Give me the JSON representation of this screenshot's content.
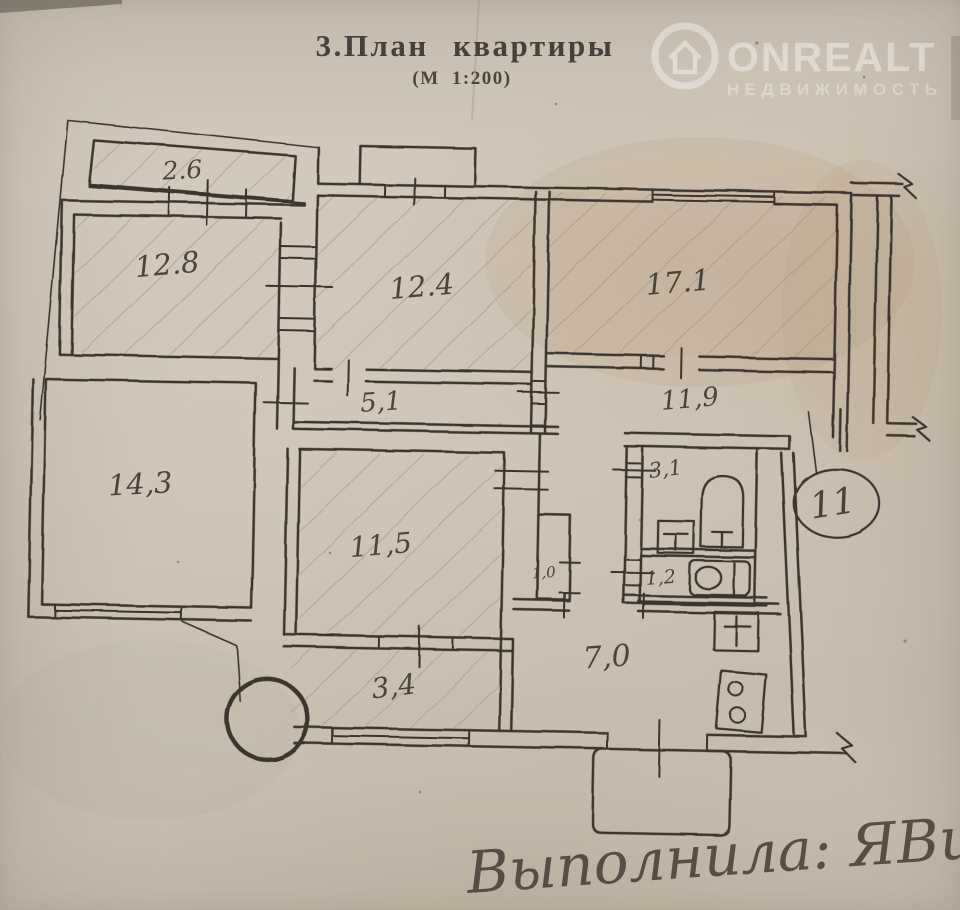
{
  "page": {
    "title": "3.План квартиры",
    "scale_note": "(М 1:200)"
  },
  "watermark": {
    "brand": "ONREALT",
    "subtitle": "НЕДВИЖИМОСТЬ"
  },
  "plan": {
    "unit_number": "11",
    "rooms": [
      {
        "name": "balcony",
        "area": "2.6"
      },
      {
        "name": "room",
        "area": "12.8"
      },
      {
        "name": "room",
        "area": "12.4"
      },
      {
        "name": "room",
        "area": "17.1"
      },
      {
        "name": "corridor",
        "area": "5,1"
      },
      {
        "name": "corridor",
        "area": "11,9"
      },
      {
        "name": "room",
        "area": "14,3"
      },
      {
        "name": "room",
        "area": "11,5"
      },
      {
        "name": "closet",
        "area": "1,0"
      },
      {
        "name": "bathroom",
        "area": "3,1"
      },
      {
        "name": "wc",
        "area": "1,2"
      },
      {
        "name": "kitchen",
        "area": "7,0"
      },
      {
        "name": "hallway",
        "area": "3,4"
      }
    ]
  },
  "annotation": {
    "handwritten": "Выполнила: ЯВиц"
  },
  "colors": {
    "paper": "#cbc2b4",
    "ink": "#3a362f",
    "stain": "#a87f52",
    "watermark": "#ffffff"
  }
}
